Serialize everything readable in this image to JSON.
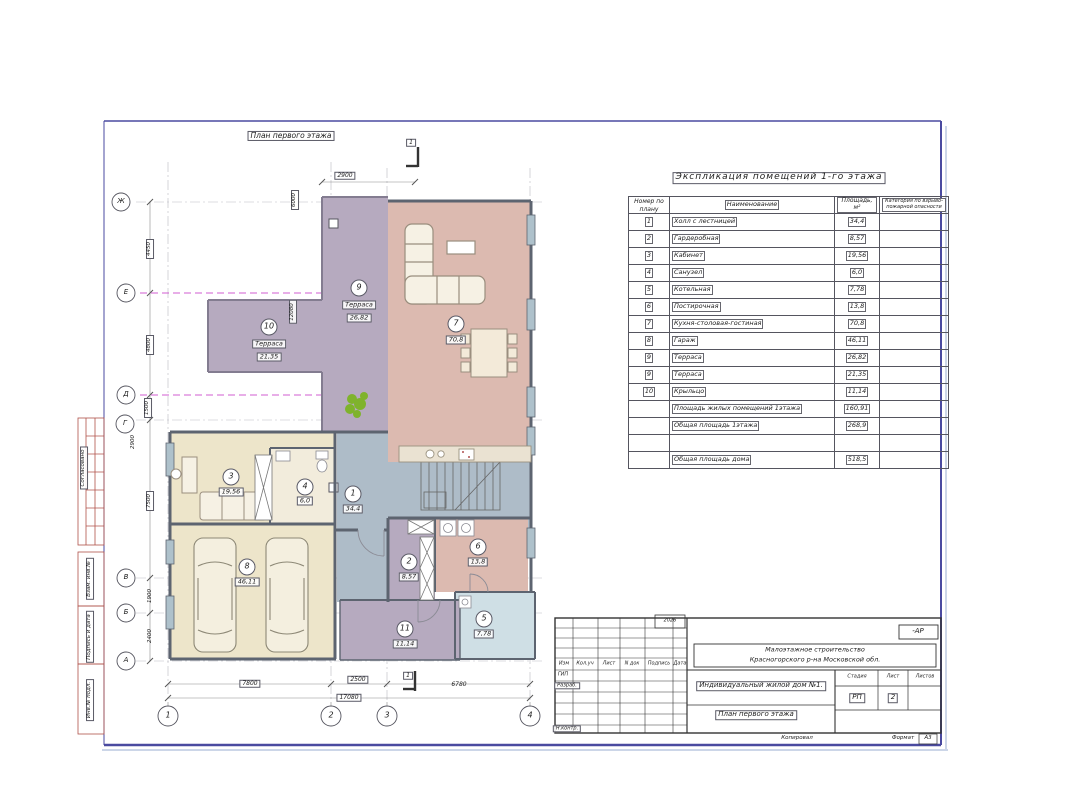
{
  "colors": {
    "room_pink": "#dcbab0",
    "room_purple": "#b6aabf",
    "room_cream": "#ede5ca",
    "room_hall_blue": "#aebcc8",
    "room_lightblue": "#cfdfe5",
    "frame_blue": "#4a4aa0",
    "axis_magenta": "#c93fc9",
    "margin_red": "#b0524a"
  },
  "margin": {
    "labels": [
      "Согласовано",
      "Взам. инв.№",
      "Подпись и дата",
      "Инв.№ подл."
    ]
  },
  "plan": {
    "title": "План первого этажа",
    "section_mark": "1",
    "axes": {
      "left": [
        "Ж",
        "Е",
        "Д",
        "Г",
        "В",
        "Б",
        "А"
      ],
      "bottom": [
        "1",
        "2",
        "3",
        "4"
      ]
    },
    "dims": {
      "top": "2900",
      "vert1": "6000",
      "vert2": "12080",
      "left": [
        "4450",
        "4800",
        "1500",
        "7500",
        "1900",
        "2400"
      ],
      "left_extra": "2900",
      "bottom": [
        "7800",
        "2500",
        "6780"
      ],
      "bottom_total": "17080"
    },
    "rooms": [
      {
        "num": "1",
        "area": "34,4"
      },
      {
        "num": "2",
        "area": "8,57"
      },
      {
        "num": "3",
        "area": "19,56"
      },
      {
        "num": "4",
        "area": "6,0"
      },
      {
        "num": "5",
        "area": "7,78"
      },
      {
        "num": "6",
        "area": "13,8"
      },
      {
        "num": "7",
        "area": "70,8"
      },
      {
        "num": "8",
        "area": "46,11"
      },
      {
        "num": "9",
        "name": "Терраса",
        "area": "26,82"
      },
      {
        "num": "10",
        "name": "Терраса",
        "area": "21,35"
      },
      {
        "num": "11",
        "area": "11,14"
      }
    ]
  },
  "explication": {
    "title": "Экспликация помещений 1-го этажа",
    "headers": {
      "num": "Номер по плану",
      "name": "Наименование",
      "area": "Площадь, м²",
      "category": "Категория по взрыво-пожарной опасности"
    },
    "rows": [
      {
        "num": "1",
        "name": "Холл с лестницей",
        "area": "34,4"
      },
      {
        "num": "2",
        "name": "Гардеробная",
        "area": "8,57"
      },
      {
        "num": "3",
        "name": "Кабинет",
        "area": "19,56"
      },
      {
        "num": "4",
        "name": "Санузел",
        "area": "6,0"
      },
      {
        "num": "5",
        "name": "Котельная",
        "area": "7,78"
      },
      {
        "num": "6",
        "name": "Постирочная",
        "area": "13,8"
      },
      {
        "num": "7",
        "name": "Кухня-столовая-гостиная",
        "area": "70,8"
      },
      {
        "num": "8",
        "name": "Гараж",
        "area": "46,11"
      },
      {
        "num": "9",
        "name": "Терраса",
        "area": "26,82"
      },
      {
        "num": "9",
        "name": "Терраса",
        "area": "21,35"
      },
      {
        "num": "10",
        "name": "Крыльцо",
        "area": "11,14"
      },
      {
        "num": "",
        "name": "Площадь жилых помещений 1этажа",
        "area": "160,91"
      },
      {
        "num": "",
        "name": "Общая площадь 1этажа",
        "area": "268,9"
      },
      {
        "num": "",
        "name": "",
        "area": ""
      },
      {
        "num": "",
        "name": "Общая площадь дома",
        "area": "518,5"
      }
    ]
  },
  "stamp": {
    "year": "2026",
    "code": "-АР",
    "org_line1": "Малоэтажное строительство",
    "org_line2": "Красногорского р-на Московской обл.",
    "object": "Индивидуальный жилой дом №1.",
    "doc_title": "План первого этажа",
    "table_headers": [
      "Изм",
      "Кол.уч",
      "Лист",
      "N док",
      "Подпись",
      "Дата"
    ],
    "roles": {
      "gip": "ГИП",
      "razrab": "Разраб.",
      "nkontr": "Н.контр."
    },
    "stage_label": "Стадия",
    "list_label": "Лист",
    "listov_label": "Листов",
    "stage": "РП",
    "list_num": "2",
    "kopiroval": "Копировал",
    "format_label": "Формат",
    "format": "А3"
  }
}
